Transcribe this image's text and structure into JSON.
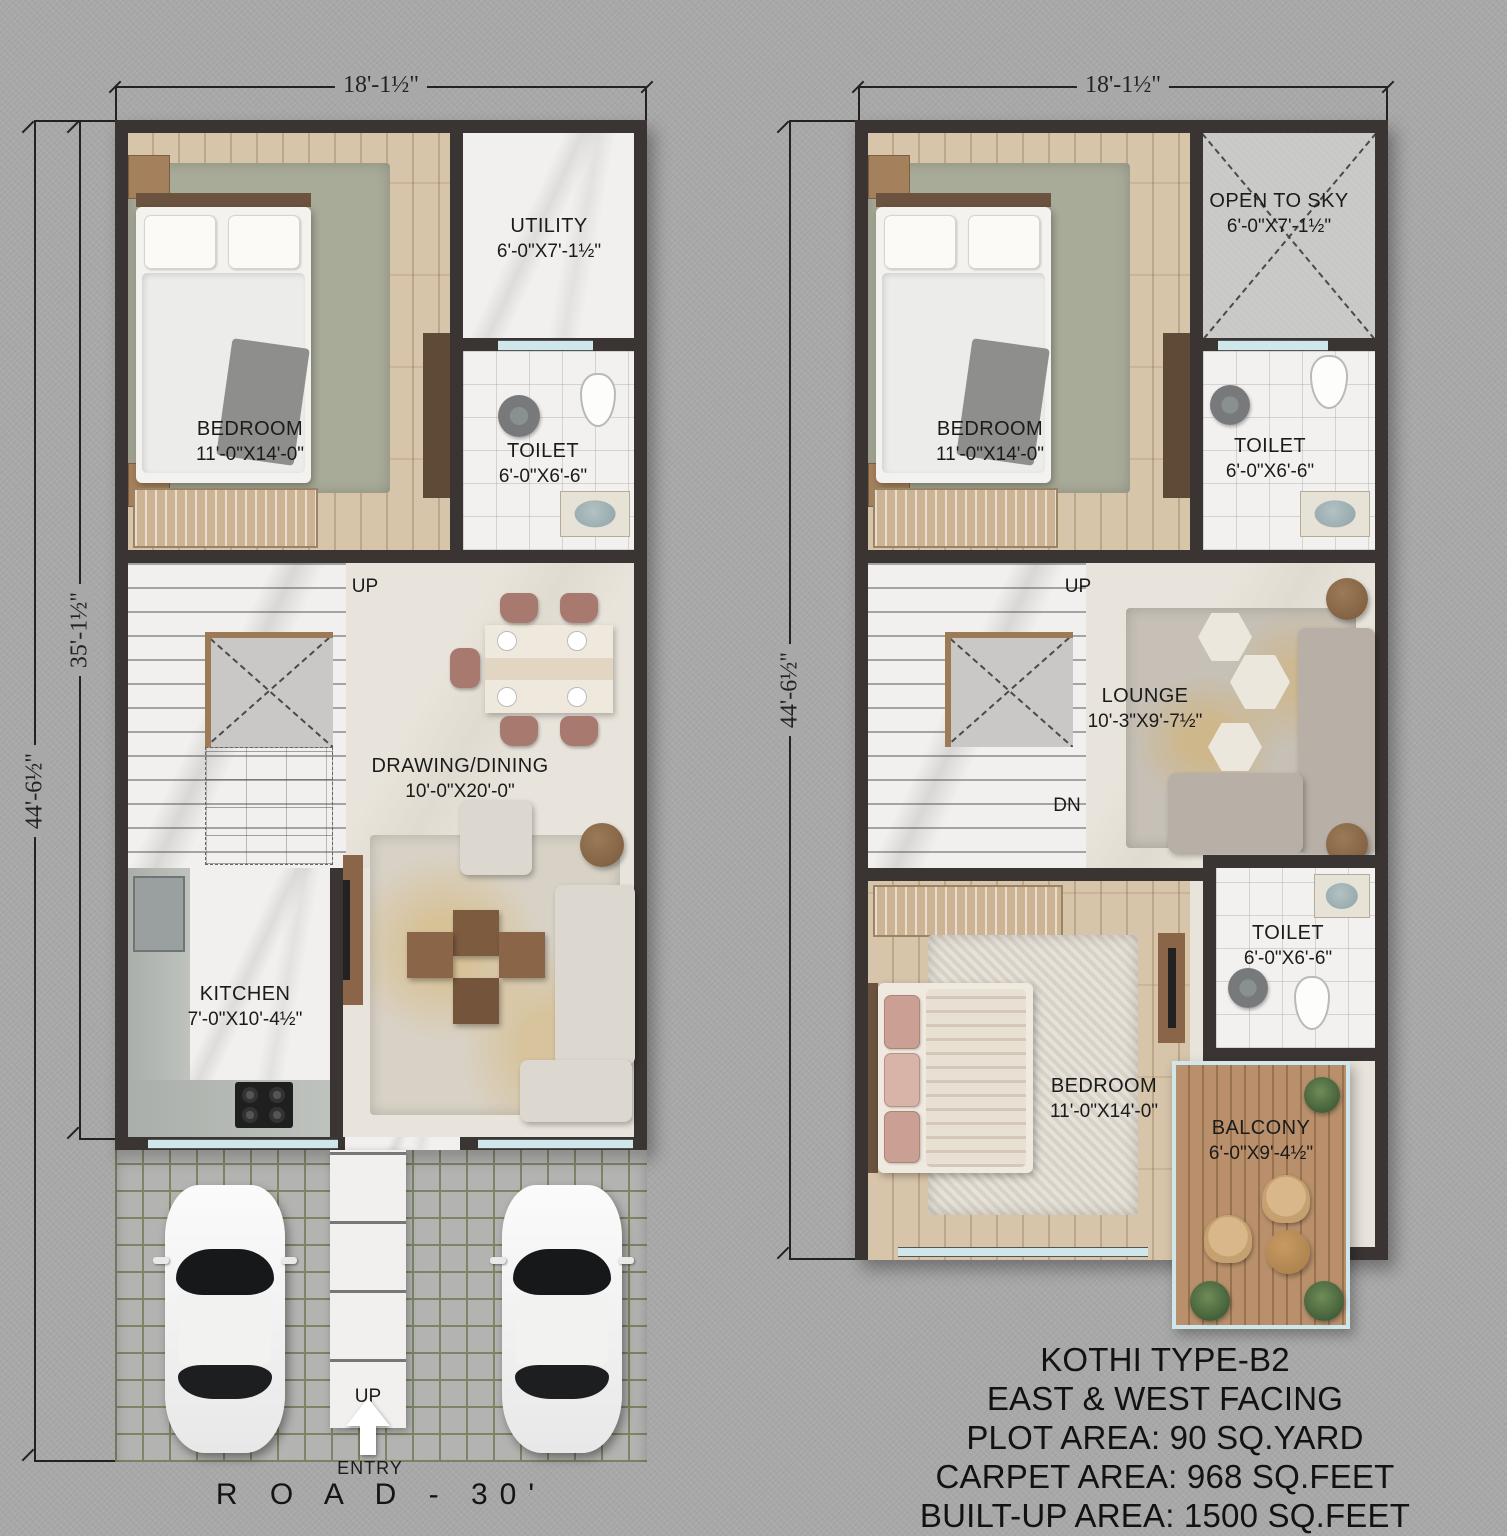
{
  "colors": {
    "background": "#a8a8a8",
    "wall": "#3a3533",
    "wood": "#d5c1a5",
    "marble": "#f1f0ee",
    "cream": "#e9e4db",
    "concrete": "#c8c8c6",
    "parking": "#b3b3b1",
    "parking_line": "#7e8465",
    "deck": "#b9906b",
    "window": "#cfe6ea",
    "dim": "#222222",
    "rose": "#a87a6f",
    "sofa": "#ddd8cf",
    "sofa_gray": "#b8b0a6",
    "brown": "#7d5b3f",
    "wood_dark": "#5f4a38",
    "rug_sage": "#a9ab99",
    "rug_beige": "#d8d2c6",
    "void_fill": "#c9c8c6",
    "stair_border": "#9c7a56",
    "steel": "#9aa0a0"
  },
  "ground_floor": {
    "dims": {
      "top": "18'-1½\"",
      "side_outer": "44'-6½\"",
      "side_inner": "35'-1½\""
    },
    "rooms": {
      "bedroom": {
        "name": "BEDROOM",
        "size": "11'-0\"X14'-0\""
      },
      "utility": {
        "name": "UTILITY",
        "size": "6'-0\"X7'-1½\""
      },
      "toilet": {
        "name": "TOILET",
        "size": "6'-0\"X6'-6\""
      },
      "drawing_dining": {
        "name": "DRAWING/DINING",
        "size": "10'-0\"X20'-0\""
      },
      "kitchen": {
        "name": "KITCHEN",
        "size": "7'-0\"X10'-4½\""
      }
    },
    "labels": {
      "stairs_up": "UP",
      "walkway_up": "UP",
      "entry": "ENTRY",
      "road": "R O A D -  30'"
    }
  },
  "first_floor": {
    "dims": {
      "top": "18'-1½\"",
      "side": "44'-6½\""
    },
    "rooms": {
      "bedroom_front": {
        "name": "BEDROOM",
        "size": "11'-0\"X14'-0\""
      },
      "open_to_sky": {
        "name": "OPEN TO SKY",
        "size": "6'-0\"X7'-1½\""
      },
      "toilet_front": {
        "name": "TOILET",
        "size": "6'-0\"X6'-6\""
      },
      "lounge": {
        "name": "LOUNGE",
        "size": "10'-3\"X9'-7½\""
      },
      "bedroom_rear": {
        "name": "BEDROOM",
        "size": "11'-0\"X14'-0\""
      },
      "toilet_rear": {
        "name": "TOILET",
        "size": "6'-0\"X6'-6\""
      },
      "balcony": {
        "name": "BALCONY",
        "size": "6'-0\"X9'-4½\""
      }
    },
    "labels": {
      "up": "UP",
      "dn": "DN"
    }
  },
  "info_block": {
    "line1": "KOTHI TYPE-B2",
    "line2": "EAST & WEST FACING",
    "line3": "PLOT AREA: 90 SQ.YARD",
    "line4": "CARPET AREA: 968 SQ.FEET",
    "line5": "BUILT-UP AREA: 1500 SQ.FEET"
  }
}
